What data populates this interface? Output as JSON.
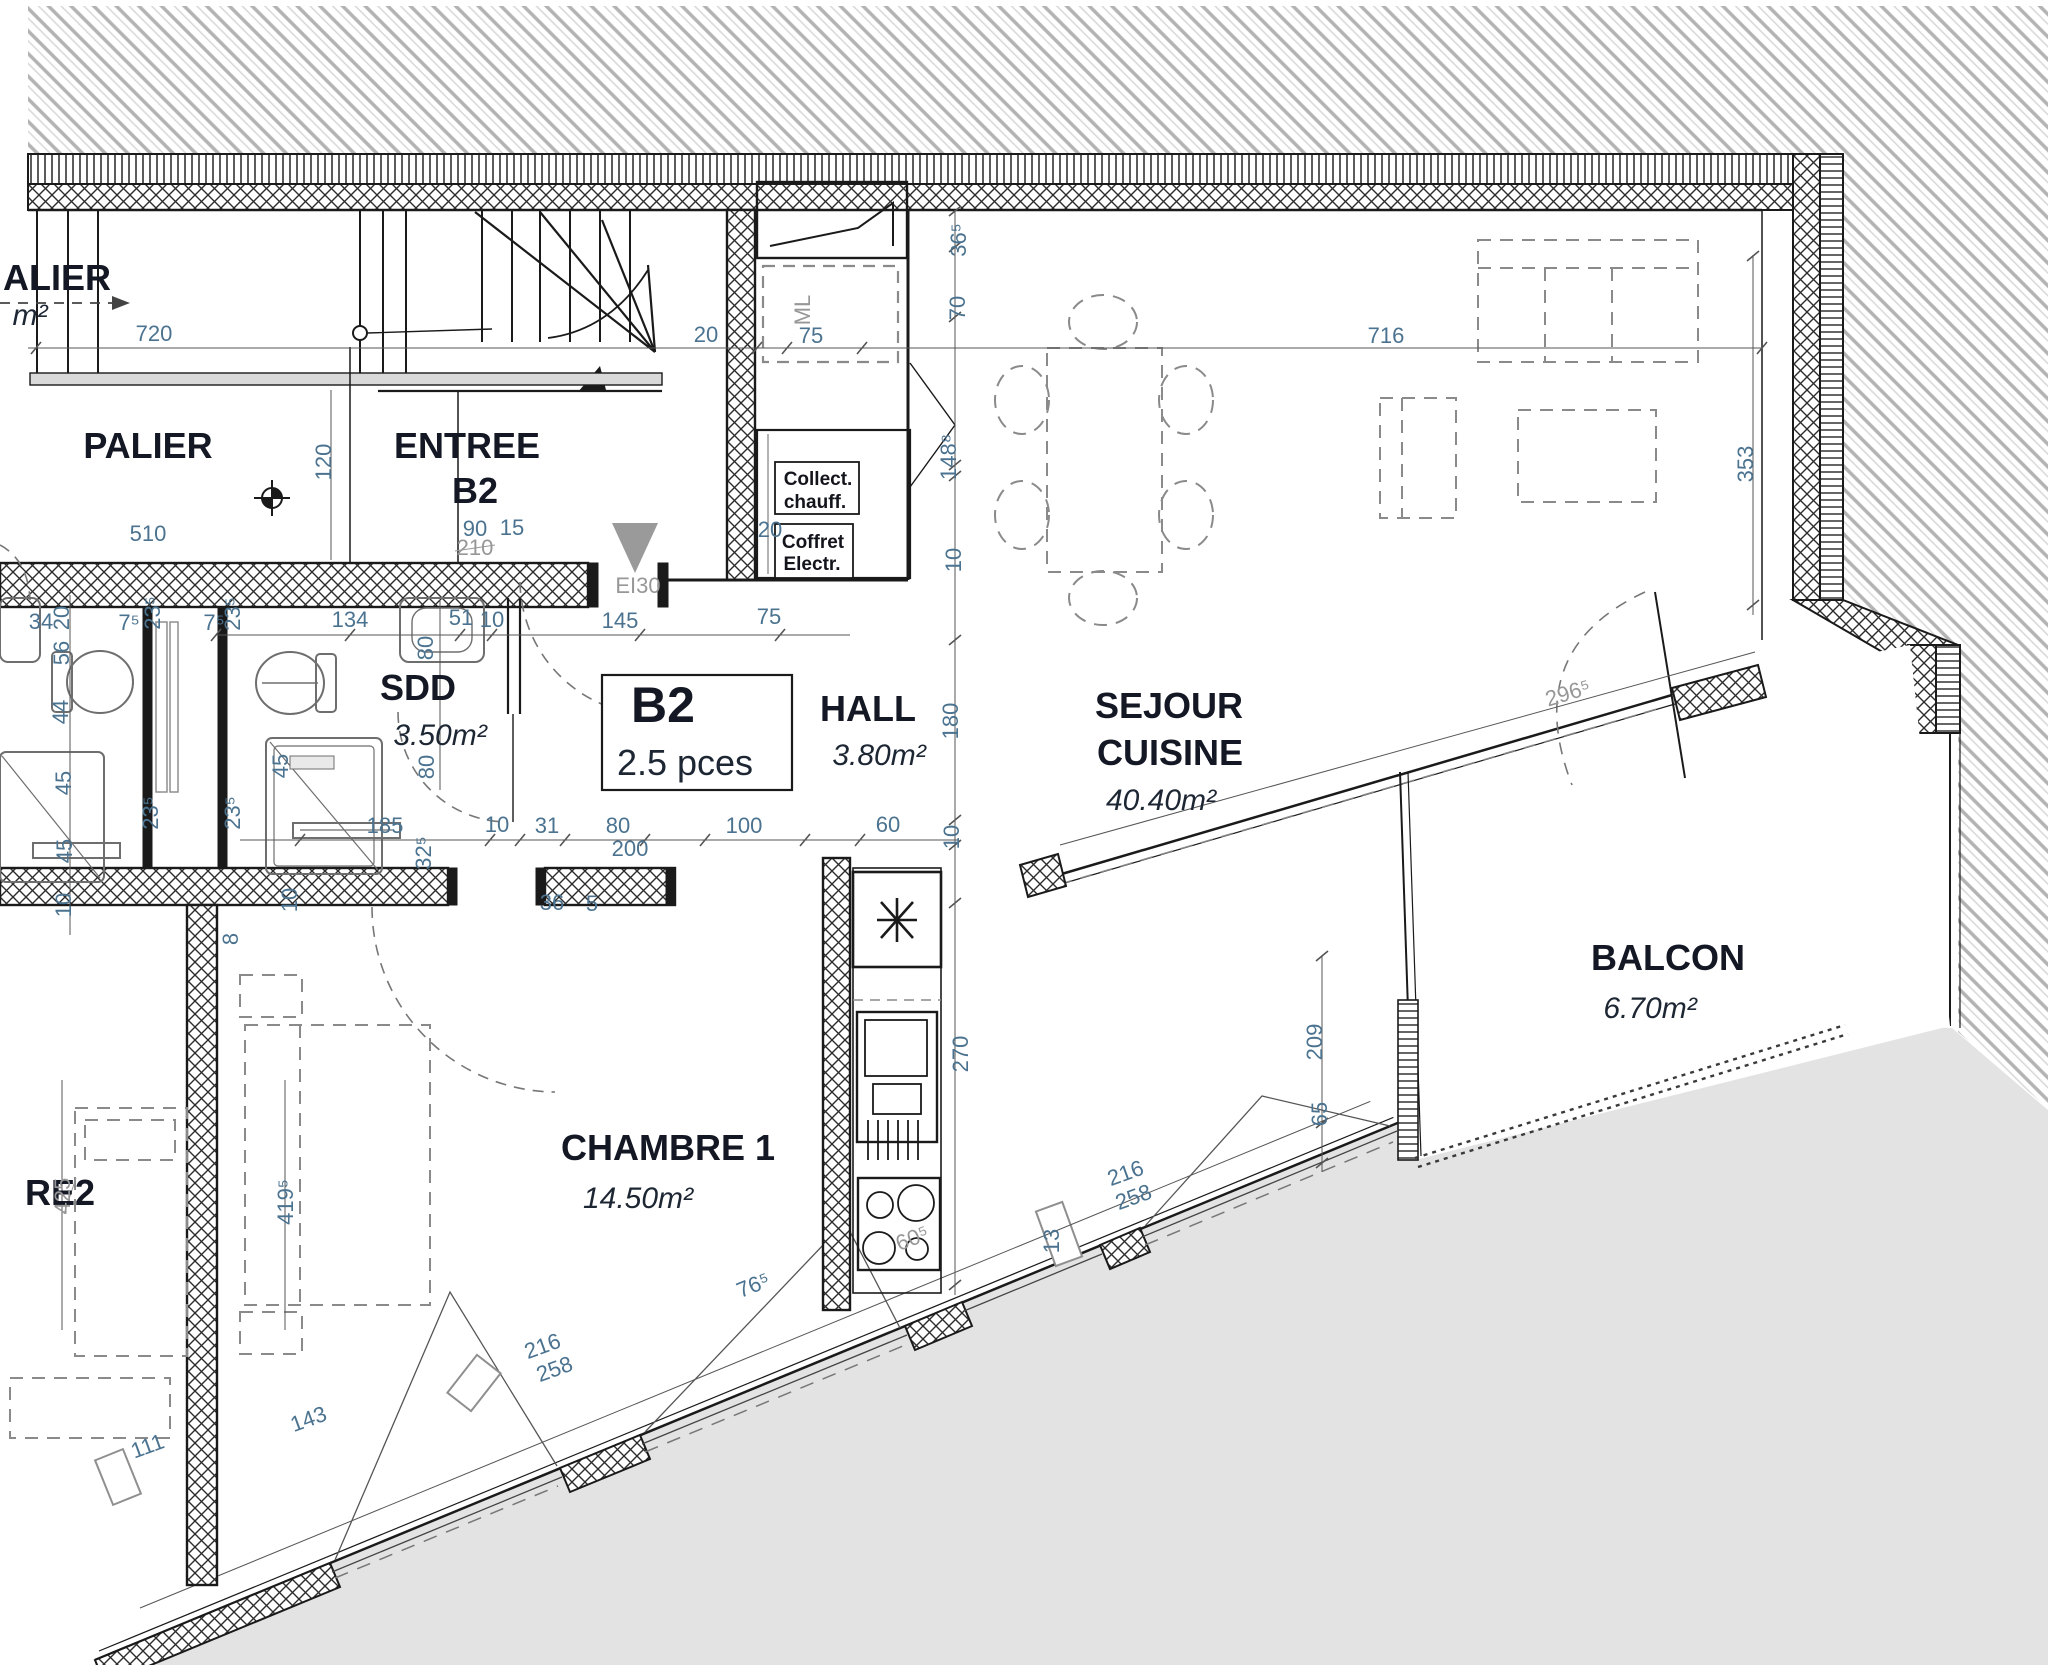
{
  "plan": {
    "unit_box": {
      "id": "B2",
      "pieces": "2.5 pces"
    },
    "rooms": [
      {
        "name": "PALIER",
        "area": null
      },
      {
        "name": "ENTREE B2",
        "area": null
      },
      {
        "name": "SDD",
        "area": "3.50m²"
      },
      {
        "name": "HALL",
        "area": "3.80m²"
      },
      {
        "name": "SEJOUR CUISINE",
        "area": "40.40m²"
      },
      {
        "name": "CHAMBRE 1",
        "area": "14.50m²"
      },
      {
        "name": "BALCON",
        "area": "6.70m²"
      },
      {
        "name": "RE2 (partial label of adjacent room)",
        "area": null
      },
      {
        "name": "ALIER (partial label of adjacent landing)",
        "area": null
      }
    ],
    "technical": {
      "fire_door": "EI30",
      "heating_cabinet": [
        "Collect.",
        "chauff."
      ],
      "electric_cabinet": [
        "Coffret",
        "Electr."
      ],
      "washing_machine": "ML"
    },
    "dimensions_cm": [
      "720",
      "510",
      "120",
      "90",
      "15",
      "210",
      "20",
      "75",
      "716",
      "36⁵",
      "70",
      "148⁸",
      "10",
      "134",
      "51",
      "145",
      "80",
      "185",
      "31",
      "200",
      "100",
      "60",
      "180",
      "34",
      "56",
      "44",
      "45",
      "23⁵",
      "7⁵",
      "32⁵",
      "36",
      "5",
      "8",
      "270",
      "13",
      "76⁵",
      "60⁵",
      "216",
      "258",
      "209",
      "65",
      "353",
      "296⁵",
      "425",
      "419⁵",
      "143",
      "111"
    ],
    "texts": [
      {
        "name": "adjacent-palier-label",
        "t": "ALIER",
        "x": 57,
        "y": 290,
        "r": 0,
        "c": "room",
        "s": 40
      },
      {
        "name": "adjacent-palier-area",
        "t": "m²",
        "x": 30,
        "y": 325,
        "r": 0,
        "c": "area",
        "s": 28
      },
      {
        "name": "dim-720",
        "t": "720",
        "x": 154,
        "y": 341,
        "r": 0,
        "c": "dim"
      },
      {
        "name": "palier-label",
        "t": "PALIER",
        "x": 148,
        "y": 458,
        "r": 0,
        "c": "room",
        "s": 38
      },
      {
        "name": "dim-510",
        "t": "510",
        "x": 148,
        "y": 541,
        "r": 0,
        "c": "dim"
      },
      {
        "name": "dim-120",
        "t": "120",
        "x": 331,
        "y": 462,
        "r": -90,
        "c": "dim"
      },
      {
        "name": "entree-label",
        "t": "ENTREE",
        "x": 467,
        "y": 458,
        "r": 0,
        "c": "room"
      },
      {
        "name": "entree-unit",
        "t": "B2",
        "x": 475,
        "y": 503,
        "r": 0,
        "c": "room"
      },
      {
        "name": "dim-90",
        "t": "90",
        "x": 475,
        "y": 536,
        "r": 0,
        "c": "dim"
      },
      {
        "name": "dim-15",
        "t": "15",
        "x": 512,
        "y": 535,
        "r": 0,
        "c": "dim"
      },
      {
        "name": "dim-210",
        "t": "210",
        "x": 475,
        "y": 555,
        "r": 0,
        "c": "dimg"
      },
      {
        "name": "door-ei30",
        "t": "EI30",
        "x": 638,
        "y": 593,
        "r": 0,
        "c": "dimg"
      },
      {
        "name": "dim-20-top",
        "t": "20",
        "x": 706,
        "y": 342,
        "r": 0,
        "c": "dim"
      },
      {
        "name": "ml-label",
        "t": "ML",
        "x": 810,
        "y": 310,
        "r": -90,
        "c": "dimg"
      },
      {
        "name": "dim-75-ml",
        "t": "75",
        "x": 811,
        "y": 343,
        "r": 0,
        "c": "dim"
      },
      {
        "name": "dim-365",
        "t": "36⁵",
        "x": 966,
        "y": 240,
        "r": -90,
        "c": "dim"
      },
      {
        "name": "dim-70",
        "t": "70",
        "x": 965,
        "y": 308,
        "r": -90,
        "c": "dim"
      },
      {
        "name": "dim-716",
        "t": "716",
        "x": 1386,
        "y": 343,
        "r": 0,
        "c": "dim"
      },
      {
        "name": "dim-1488",
        "t": "148⁸",
        "x": 956,
        "y": 457,
        "r": -90,
        "c": "dim"
      },
      {
        "name": "dim-10-a",
        "t": "10",
        "x": 961,
        "y": 560,
        "r": -90,
        "c": "dim"
      },
      {
        "name": "cab-collect-1",
        "t": "Collect.",
        "x": 818,
        "y": 485,
        "r": 0,
        "c": "tech"
      },
      {
        "name": "cab-collect-2",
        "t": "chauff.",
        "x": 815,
        "y": 508,
        "r": 0,
        "c": "tech"
      },
      {
        "name": "cab-coffret-1",
        "t": "Coffret",
        "x": 813,
        "y": 548,
        "r": 0,
        "c": "tech"
      },
      {
        "name": "cab-coffret-2",
        "t": "Electr.",
        "x": 812,
        "y": 570,
        "r": 0,
        "c": "tech"
      },
      {
        "name": "dim-20-b",
        "t": "20",
        "x": 770,
        "y": 537,
        "r": 0,
        "c": "dim"
      },
      {
        "name": "dim-134",
        "t": "134",
        "x": 350,
        "y": 627,
        "r": 0,
        "c": "dim"
      },
      {
        "name": "dim-51",
        "t": "51",
        "x": 461,
        "y": 625,
        "r": 0,
        "c": "dim"
      },
      {
        "name": "dim-10-b",
        "t": "10",
        "x": 492,
        "y": 627,
        "r": 0,
        "c": "dim"
      },
      {
        "name": "dim-145",
        "t": "145",
        "x": 620,
        "y": 628,
        "r": 0,
        "c": "dim"
      },
      {
        "name": "dim-75-b",
        "t": "75",
        "x": 769,
        "y": 624,
        "r": 0,
        "c": "dim"
      },
      {
        "name": "dim-80-a",
        "t": "80",
        "x": 433,
        "y": 648,
        "r": -90,
        "c": "dim"
      },
      {
        "name": "sdd-label",
        "t": "SDD",
        "x": 418,
        "y": 700,
        "r": 0,
        "c": "room",
        "s": 34
      },
      {
        "name": "sdd-area",
        "t": "3.50m²",
        "x": 440,
        "y": 745,
        "r": 0,
        "c": "area"
      },
      {
        "name": "dim-80-b",
        "t": "80",
        "x": 434,
        "y": 767,
        "r": -90,
        "c": "dim"
      },
      {
        "name": "unit-box-id",
        "t": "B2",
        "x": 663,
        "y": 722,
        "r": 0,
        "c": "unitbig"
      },
      {
        "name": "unit-box-pces",
        "t": "2.5 pces",
        "x": 685,
        "y": 775,
        "r": 0,
        "c": "pces"
      },
      {
        "name": "hall-label",
        "t": "HALL",
        "x": 868,
        "y": 721,
        "r": 0,
        "c": "room"
      },
      {
        "name": "hall-area",
        "t": "3.80m²",
        "x": 879,
        "y": 765,
        "r": 0,
        "c": "area"
      },
      {
        "name": "dim-180",
        "t": "180",
        "x": 958,
        "y": 721,
        "r": -90,
        "c": "dim"
      },
      {
        "name": "sejour-label-1",
        "t": "SEJOUR",
        "x": 1169,
        "y": 718,
        "r": 0,
        "c": "room"
      },
      {
        "name": "sejour-label-2",
        "t": "CUISINE",
        "x": 1170,
        "y": 765,
        "r": 0,
        "c": "room"
      },
      {
        "name": "sejour-area",
        "t": "40.40m²",
        "x": 1161,
        "y": 810,
        "r": 0,
        "c": "area"
      },
      {
        "name": "dim-34",
        "t": "34",
        "x": 41,
        "y": 629,
        "r": 0,
        "c": "dim"
      },
      {
        "name": "dim-20-l",
        "t": "20",
        "x": 69,
        "y": 618,
        "r": -90,
        "c": "dim"
      },
      {
        "name": "dim-56",
        "t": "56",
        "x": 69,
        "y": 653,
        "r": -90,
        "c": "dim"
      },
      {
        "name": "dim-44",
        "t": "44",
        "x": 68,
        "y": 712,
        "r": -90,
        "c": "dim"
      },
      {
        "name": "dim-45-a",
        "t": "45",
        "x": 71,
        "y": 783,
        "r": -90,
        "c": "dim"
      },
      {
        "name": "dim-45-b",
        "t": "45",
        "x": 72,
        "y": 851,
        "r": -90,
        "c": "dim"
      },
      {
        "name": "dim-10-l",
        "t": "10",
        "x": 71,
        "y": 905,
        "r": -90,
        "c": "dim"
      },
      {
        "name": "dim-235-a",
        "t": "23⁵",
        "x": 160,
        "y": 613,
        "r": -90,
        "c": "dim"
      },
      {
        "name": "dim-75s-a",
        "t": "7⁵",
        "x": 129,
        "y": 630,
        "r": 0,
        "c": "dim"
      },
      {
        "name": "dim-235-b",
        "t": "23⁵",
        "x": 240,
        "y": 614,
        "r": -90,
        "c": "dim"
      },
      {
        "name": "dim-75s-b",
        "t": "7⁵",
        "x": 214,
        "y": 630,
        "r": 0,
        "c": "dim"
      },
      {
        "name": "dim-235-c",
        "t": "23⁵",
        "x": 158,
        "y": 813,
        "r": -90,
        "c": "dim"
      },
      {
        "name": "dim-235-d",
        "t": "23⁵",
        "x": 240,
        "y": 813,
        "r": -90,
        "c": "dim"
      },
      {
        "name": "dim-45-c",
        "t": "45",
        "x": 288,
        "y": 766,
        "r": -90,
        "c": "dim"
      },
      {
        "name": "dim-185",
        "t": "185",
        "x": 385,
        "y": 833,
        "r": 0,
        "c": "dim"
      },
      {
        "name": "dim-10-c",
        "t": "10",
        "x": 497,
        "y": 832,
        "r": 0,
        "c": "dim"
      },
      {
        "name": "dim-31",
        "t": "31",
        "x": 547,
        "y": 833,
        "r": 0,
        "c": "dim"
      },
      {
        "name": "dim-80-c",
        "t": "80",
        "x": 618,
        "y": 833,
        "r": 0,
        "c": "dim"
      },
      {
        "name": "dim-200",
        "t": "200",
        "x": 630,
        "y": 856,
        "r": 0,
        "c": "dim"
      },
      {
        "name": "dim-100",
        "t": "100",
        "x": 744,
        "y": 833,
        "r": 0,
        "c": "dim"
      },
      {
        "name": "dim-60",
        "t": "60",
        "x": 888,
        "y": 832,
        "r": 0,
        "c": "dim"
      },
      {
        "name": "dim-10-d",
        "t": "10",
        "x": 959,
        "y": 837,
        "r": -90,
        "c": "dim"
      },
      {
        "name": "dim-325",
        "t": "32⁵",
        "x": 431,
        "y": 853,
        "r": -90,
        "c": "dim"
      },
      {
        "name": "dim-36",
        "t": "36",
        "x": 552,
        "y": 910,
        "r": 0,
        "c": "dim"
      },
      {
        "name": "dim-5",
        "t": "5",
        "x": 592,
        "y": 911,
        "r": 0,
        "c": "dim"
      },
      {
        "name": "dim-10-e",
        "t": "10",
        "x": 297,
        "y": 900,
        "r": -90,
        "c": "dim"
      },
      {
        "name": "dim-8",
        "t": "8",
        "x": 238,
        "y": 939,
        "r": -90,
        "c": "dim"
      },
      {
        "name": "chambre1-label",
        "t": "CHAMBRE 1",
        "x": 668,
        "y": 1160,
        "r": 0,
        "c": "room"
      },
      {
        "name": "chambre1-area",
        "t": "14.50m²",
        "x": 638,
        "y": 1208,
        "r": 0,
        "c": "area"
      },
      {
        "name": "dim-270",
        "t": "270",
        "x": 968,
        "y": 1054,
        "r": -90,
        "c": "dim"
      },
      {
        "name": "dim-13",
        "t": "13",
        "x": 1059,
        "y": 1241,
        "r": -90,
        "c": "dim"
      },
      {
        "name": "dim-605",
        "t": "60⁵",
        "x": 915,
        "y": 1245,
        "r": -22,
        "c": "dimg"
      },
      {
        "name": "dim-765",
        "t": "76⁵",
        "x": 756,
        "y": 1292,
        "r": -22,
        "c": "dim"
      },
      {
        "name": "dim-216-a",
        "t": "216",
        "x": 1128,
        "y": 1180,
        "r": -20,
        "c": "dim"
      },
      {
        "name": "dim-258-a",
        "t": "258",
        "x": 1136,
        "y": 1204,
        "r": -20,
        "c": "dim"
      },
      {
        "name": "dim-209",
        "t": "209",
        "x": 1322,
        "y": 1042,
        "r": -90,
        "c": "dim"
      },
      {
        "name": "dim-65",
        "t": "65",
        "x": 1327,
        "y": 1114,
        "r": -90,
        "c": "dim"
      },
      {
        "name": "dim-353",
        "t": "353",
        "x": 1753,
        "y": 464,
        "r": -90,
        "c": "dim"
      },
      {
        "name": "dim-2965",
        "t": "296⁵",
        "x": 1570,
        "y": 700,
        "r": -17,
        "c": "dimg"
      },
      {
        "name": "balcon-label",
        "t": "BALCON",
        "x": 1668,
        "y": 970,
        "r": 0,
        "c": "room"
      },
      {
        "name": "balcon-area",
        "t": "6.70m²",
        "x": 1650,
        "y": 1018,
        "r": 0,
        "c": "area"
      },
      {
        "name": "chambre2-partial-label",
        "t": "RE2",
        "x": 60,
        "y": 1205,
        "r": 0,
        "c": "room",
        "s": 40
      },
      {
        "name": "dim-425",
        "t": "425",
        "x": 70,
        "y": 1196,
        "r": -90,
        "c": "dimg"
      },
      {
        "name": "dim-4195",
        "t": "419⁵",
        "x": 293,
        "y": 1202,
        "r": -90,
        "c": "dim"
      },
      {
        "name": "dim-143",
        "t": "143",
        "x": 311,
        "y": 1426,
        "r": -20,
        "c": "dim"
      },
      {
        "name": "dim-111",
        "t": "111",
        "x": 150,
        "y": 1453,
        "r": -20,
        "c": "dim"
      },
      {
        "name": "dim-216-b",
        "t": "216",
        "x": 545,
        "y": 1353,
        "r": -20,
        "c": "dim"
      },
      {
        "name": "dim-258-b",
        "t": "258",
        "x": 557,
        "y": 1376,
        "r": -20,
        "c": "dim"
      }
    ]
  }
}
